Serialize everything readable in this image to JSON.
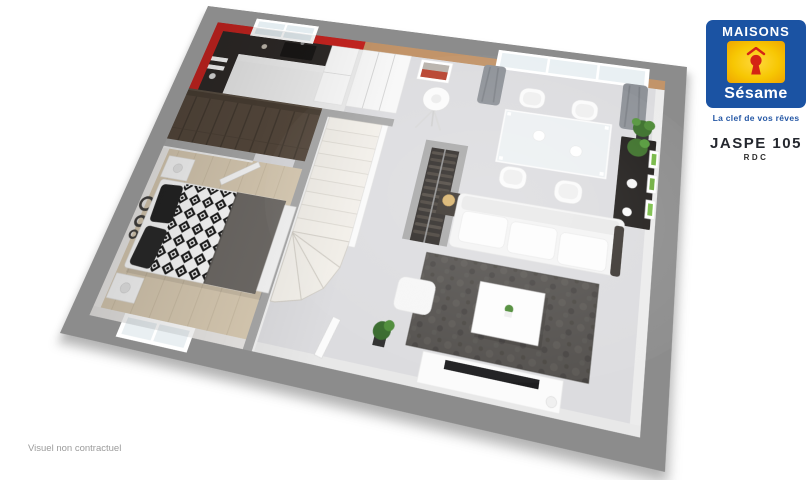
{
  "header": {
    "title": "JASPE 105",
    "level": "RDC"
  },
  "logo": {
    "brand_top": "MAISONS",
    "brand_script": "Sésame",
    "tagline": "La clef de vos rêves"
  },
  "footer": {
    "disclaimer": "Visuel non contractuel"
  },
  "colors": {
    "brand_blue": "#1b53a3",
    "brand_yellow": "#f6c200",
    "keyhole_red": "#d42414",
    "frame_gray": "#8c8c8c",
    "kitchen_red": "#c62420",
    "wall_tan": "#c29469",
    "tagline_blue": "#2457a5",
    "title_text": "#24272e",
    "disclaimer_gray": "#9b9b9b"
  }
}
